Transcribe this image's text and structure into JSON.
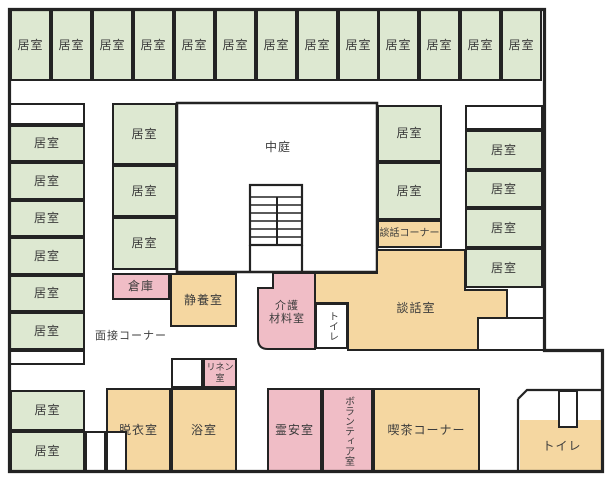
{
  "title": "施設平面図",
  "colors": {
    "wall": "#232323",
    "green": "#dde8d1",
    "orange": "#f5d7a1",
    "pink": "#f0bdc6",
    "white": "#ffffff",
    "text": "#3c3c3c"
  },
  "rooms": [
    {
      "name": "resident-room",
      "label": "居室",
      "fill": "green",
      "x": 10,
      "y": 9,
      "w": 41,
      "h": 72
    },
    {
      "name": "resident-room",
      "label": "居室",
      "fill": "green",
      "x": 51,
      "y": 9,
      "w": 41,
      "h": 72
    },
    {
      "name": "resident-room",
      "label": "居室",
      "fill": "green",
      "x": 92,
      "y": 9,
      "w": 41,
      "h": 72
    },
    {
      "name": "resident-room",
      "label": "居室",
      "fill": "green",
      "x": 133,
      "y": 9,
      "w": 41,
      "h": 72
    },
    {
      "name": "resident-room",
      "label": "居室",
      "fill": "green",
      "x": 174,
      "y": 9,
      "w": 41,
      "h": 72
    },
    {
      "name": "resident-room",
      "label": "居室",
      "fill": "green",
      "x": 215,
      "y": 9,
      "w": 41,
      "h": 72
    },
    {
      "name": "resident-room",
      "label": "居室",
      "fill": "green",
      "x": 256,
      "y": 9,
      "w": 41,
      "h": 72
    },
    {
      "name": "resident-room",
      "label": "居室",
      "fill": "green",
      "x": 297,
      "y": 9,
      "w": 41,
      "h": 72
    },
    {
      "name": "resident-room",
      "label": "居室",
      "fill": "green",
      "x": 338,
      "y": 9,
      "w": 41,
      "h": 72
    },
    {
      "name": "resident-room",
      "label": "居室",
      "fill": "green",
      "x": 378,
      "y": 9,
      "w": 41,
      "h": 72
    },
    {
      "name": "resident-room",
      "label": "居室",
      "fill": "green",
      "x": 419,
      "y": 9,
      "w": 41,
      "h": 72
    },
    {
      "name": "resident-room",
      "label": "居室",
      "fill": "green",
      "x": 460,
      "y": 9,
      "w": 41,
      "h": 72
    },
    {
      "name": "resident-room",
      "label": "居室",
      "fill": "green",
      "x": 501,
      "y": 9,
      "w": 41,
      "h": 72
    },
    {
      "name": "unlabeled-cell",
      "label": "",
      "fill": "white",
      "x": 9,
      "y": 103,
      "w": 76,
      "h": 22
    },
    {
      "name": "resident-room",
      "label": "居室",
      "fill": "green",
      "x": 9,
      "y": 125,
      "w": 76,
      "h": 37
    },
    {
      "name": "resident-room",
      "label": "居室",
      "fill": "green",
      "x": 9,
      "y": 162,
      "w": 76,
      "h": 38
    },
    {
      "name": "resident-room",
      "label": "居室",
      "fill": "green",
      "x": 9,
      "y": 200,
      "w": 76,
      "h": 37
    },
    {
      "name": "resident-room",
      "label": "居室",
      "fill": "green",
      "x": 9,
      "y": 237,
      "w": 76,
      "h": 38
    },
    {
      "name": "resident-room",
      "label": "居室",
      "fill": "green",
      "x": 9,
      "y": 275,
      "w": 76,
      "h": 37
    },
    {
      "name": "resident-room",
      "label": "居室",
      "fill": "green",
      "x": 9,
      "y": 312,
      "w": 76,
      "h": 38
    },
    {
      "name": "unlabeled-cell",
      "label": "",
      "fill": "white",
      "x": 9,
      "y": 350,
      "w": 76,
      "h": 15
    },
    {
      "name": "resident-room",
      "label": "居室",
      "fill": "green",
      "x": 10,
      "y": 390,
      "w": 75,
      "h": 41
    },
    {
      "name": "resident-room",
      "label": "居室",
      "fill": "green",
      "x": 10,
      "y": 431,
      "w": 75,
      "h": 41
    },
    {
      "name": "resident-room",
      "label": "居室",
      "fill": "green",
      "x": 112,
      "y": 103,
      "w": 65,
      "h": 62
    },
    {
      "name": "resident-room",
      "label": "居室",
      "fill": "green",
      "x": 112,
      "y": 165,
      "w": 65,
      "h": 52
    },
    {
      "name": "resident-room",
      "label": "居室",
      "fill": "green",
      "x": 112,
      "y": 217,
      "w": 65,
      "h": 53
    },
    {
      "name": "storage-room",
      "label": "倉庫",
      "fill": "pink",
      "x": 112,
      "y": 273,
      "w": 58,
      "h": 27
    },
    {
      "name": "rest-room",
      "label": "静養室",
      "fill": "orange",
      "x": 170,
      "y": 273,
      "w": 67,
      "h": 54
    },
    {
      "name": "resident-room",
      "label": "居室",
      "fill": "green",
      "x": 377,
      "y": 105,
      "w": 65,
      "h": 57
    },
    {
      "name": "resident-room",
      "label": "居室",
      "fill": "green",
      "x": 377,
      "y": 162,
      "w": 65,
      "h": 58
    },
    {
      "name": "conversation-corner",
      "label": "談話コーナー",
      "fill": "orange",
      "x": 377,
      "y": 220,
      "w": 65,
      "h": 28,
      "size": 10
    },
    {
      "name": "unlabeled-cell",
      "label": "",
      "fill": "white",
      "x": 465,
      "y": 105,
      "w": 78,
      "h": 25
    },
    {
      "name": "resident-room",
      "label": "居室",
      "fill": "green",
      "x": 465,
      "y": 130,
      "w": 78,
      "h": 40
    },
    {
      "name": "resident-room",
      "label": "居室",
      "fill": "green",
      "x": 465,
      "y": 170,
      "w": 78,
      "h": 38
    },
    {
      "name": "resident-room",
      "label": "居室",
      "fill": "green",
      "x": 465,
      "y": 208,
      "w": 78,
      "h": 40
    },
    {
      "name": "resident-room",
      "label": "居室",
      "fill": "green",
      "x": 465,
      "y": 248,
      "w": 78,
      "h": 40
    },
    {
      "name": "linen-room",
      "label": "リネン\n室",
      "fill": "pink",
      "x": 203,
      "y": 358,
      "w": 34,
      "h": 30,
      "size": 9
    },
    {
      "name": "unlabeled-cell",
      "label": "",
      "fill": "white",
      "x": 171,
      "y": 358,
      "w": 32,
      "h": 30
    },
    {
      "name": "changing-room",
      "label": "脱衣室",
      "fill": "orange",
      "x": 106,
      "y": 388,
      "w": 65,
      "h": 85
    },
    {
      "name": "bathroom",
      "label": "浴室",
      "fill": "orange",
      "x": 171,
      "y": 388,
      "w": 66,
      "h": 85
    },
    {
      "name": "unlabeled-cell",
      "label": "",
      "fill": "white",
      "x": 85,
      "y": 431,
      "w": 21,
      "h": 41
    },
    {
      "name": "unlabeled-cell",
      "label": "",
      "fill": "white",
      "x": 106,
      "y": 431,
      "w": 21,
      "h": 41
    },
    {
      "name": "mortuary-room",
      "label": "霊安室",
      "fill": "pink",
      "x": 267,
      "y": 388,
      "w": 55,
      "h": 85
    },
    {
      "name": "volunteer-room",
      "label": "ボランティア室",
      "fill": "pink",
      "x": 322,
      "y": 388,
      "w": 51,
      "h": 85,
      "vertical": true,
      "size": 10
    },
    {
      "name": "cafe-corner",
      "label": "喫茶コーナー",
      "fill": "orange",
      "x": 373,
      "y": 388,
      "w": 107,
      "h": 85
    },
    {
      "name": "toilet-room",
      "label": "トイレ",
      "fill": "white",
      "x": 315,
      "y": 303,
      "w": 33,
      "h": 46,
      "vertical": true,
      "size": 10
    },
    {
      "name": "toilet-room",
      "label": "トイレ",
      "fill": "orange",
      "x": 520,
      "y": 420,
      "w": 84,
      "h": 52,
      "noborder": true
    },
    {
      "name": "unlabeled-cell",
      "label": "",
      "fill": "white",
      "x": 558,
      "y": 390,
      "w": 20,
      "h": 38
    }
  ],
  "free_labels": [
    {
      "name": "courtyard-label",
      "label": "中庭",
      "x": 254,
      "y": 140,
      "w": 48,
      "size": 12
    },
    {
      "name": "interview-corner-label",
      "label": "面接コーナー",
      "x": 91,
      "y": 330,
      "w": 80,
      "size": 11
    },
    {
      "name": "conversation-room-label",
      "label": "談話室",
      "x": 386,
      "y": 301,
      "w": 60,
      "size": 12
    },
    {
      "name": "care-materials-room-label",
      "label": "介護\n材料室",
      "x": 257,
      "y": 300,
      "w": 60,
      "size": 11
    }
  ]
}
